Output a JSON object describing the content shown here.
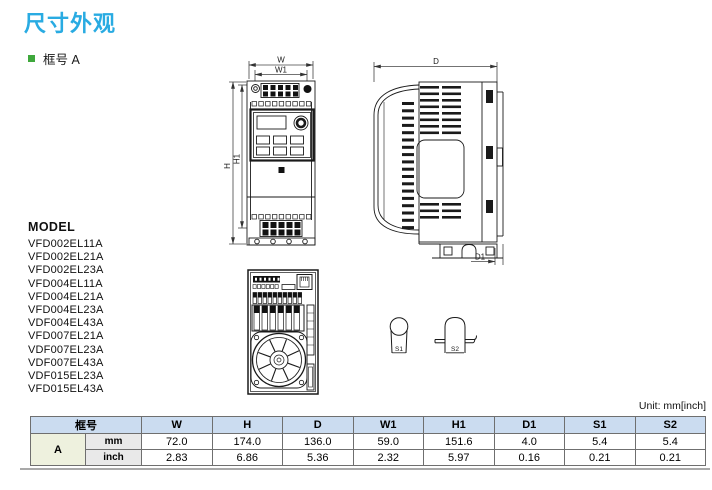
{
  "page": {
    "title": "尺寸外观",
    "section_bullet": "框号 A",
    "unit_note": "Unit: mm[inch]"
  },
  "colors": {
    "title_accent": "#29abe2",
    "bullet_green": "#3fa83c",
    "table_header_bg": "#cbdcf0",
    "frame_cell_bg": "#eef1de",
    "unit_cell_bg": "#e9e9e9",
    "line_art": "#1a1a1a"
  },
  "model_list": {
    "heading": "MODEL",
    "models": [
      "VFD002EL11A",
      "VFD002EL21A",
      "VFD002EL23A",
      "VFD004EL11A",
      "VFD004EL21A",
      "VFD004EL23A",
      "VDF004EL43A",
      "VFD007EL21A",
      "VDF007EL23A",
      "VDF007EL43A",
      "VDF015EL23A",
      "VFD015EL43A"
    ]
  },
  "diagram_labels": {
    "front": {
      "w": "W",
      "w1": "W1",
      "h": "H",
      "h1": "H1"
    },
    "side": {
      "d": "D",
      "d1": "D1"
    },
    "screws": {
      "s1": "S1",
      "s2": "S2"
    }
  },
  "dimensions_table": {
    "frame_header": "框号",
    "columns": [
      "W",
      "H",
      "D",
      "W1",
      "H1",
      "D1",
      "S1",
      "S2"
    ],
    "frame": "A",
    "rows": [
      {
        "unit": "mm",
        "values": [
          "72.0",
          "174.0",
          "136.0",
          "59.0",
          "151.6",
          "4.0",
          "5.4",
          "5.4"
        ]
      },
      {
        "unit": "inch",
        "values": [
          "2.83",
          "6.86",
          "5.36",
          "2.32",
          "5.97",
          "0.16",
          "0.21",
          "0.21"
        ]
      }
    ]
  }
}
